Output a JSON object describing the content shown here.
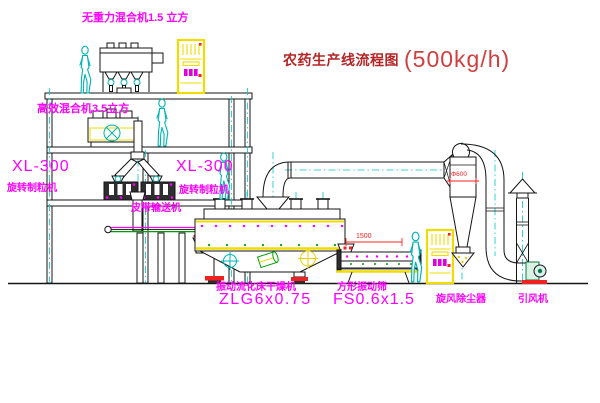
{
  "title": {
    "text": "农药生产线流程图",
    "capacity": "(500kg/h)"
  },
  "labels": {
    "gravity_mixer": "无重力混合机1.5 立方",
    "high_mixer": "高效混合机3.5立方",
    "xl_left_model": "XL-300",
    "xl_left_name": "旋转制粒机",
    "xl_right_model": "XL-300",
    "xl_right_name": "旋转制粒机",
    "conveyor": "皮带输送机",
    "dryer_name": "振动流化床干燥机",
    "dryer_model": "ZLG6x0.75",
    "screen_name": "方形振动筛",
    "screen_model": "FS0.6x1.5",
    "cyclone": "旋风除尘器",
    "fan": "引风机"
  },
  "dims": {
    "screen": "1500",
    "cyclone": "Φ600"
  },
  "colors": {
    "label_magenta": "#ff00ff",
    "title_red": "#b52525",
    "line_black": "#141414",
    "centerline_cyan": "#00c8c8",
    "equipment_yellow": "#f0dc00",
    "accent_green": "#00a000",
    "accent_red": "#ee2222"
  }
}
